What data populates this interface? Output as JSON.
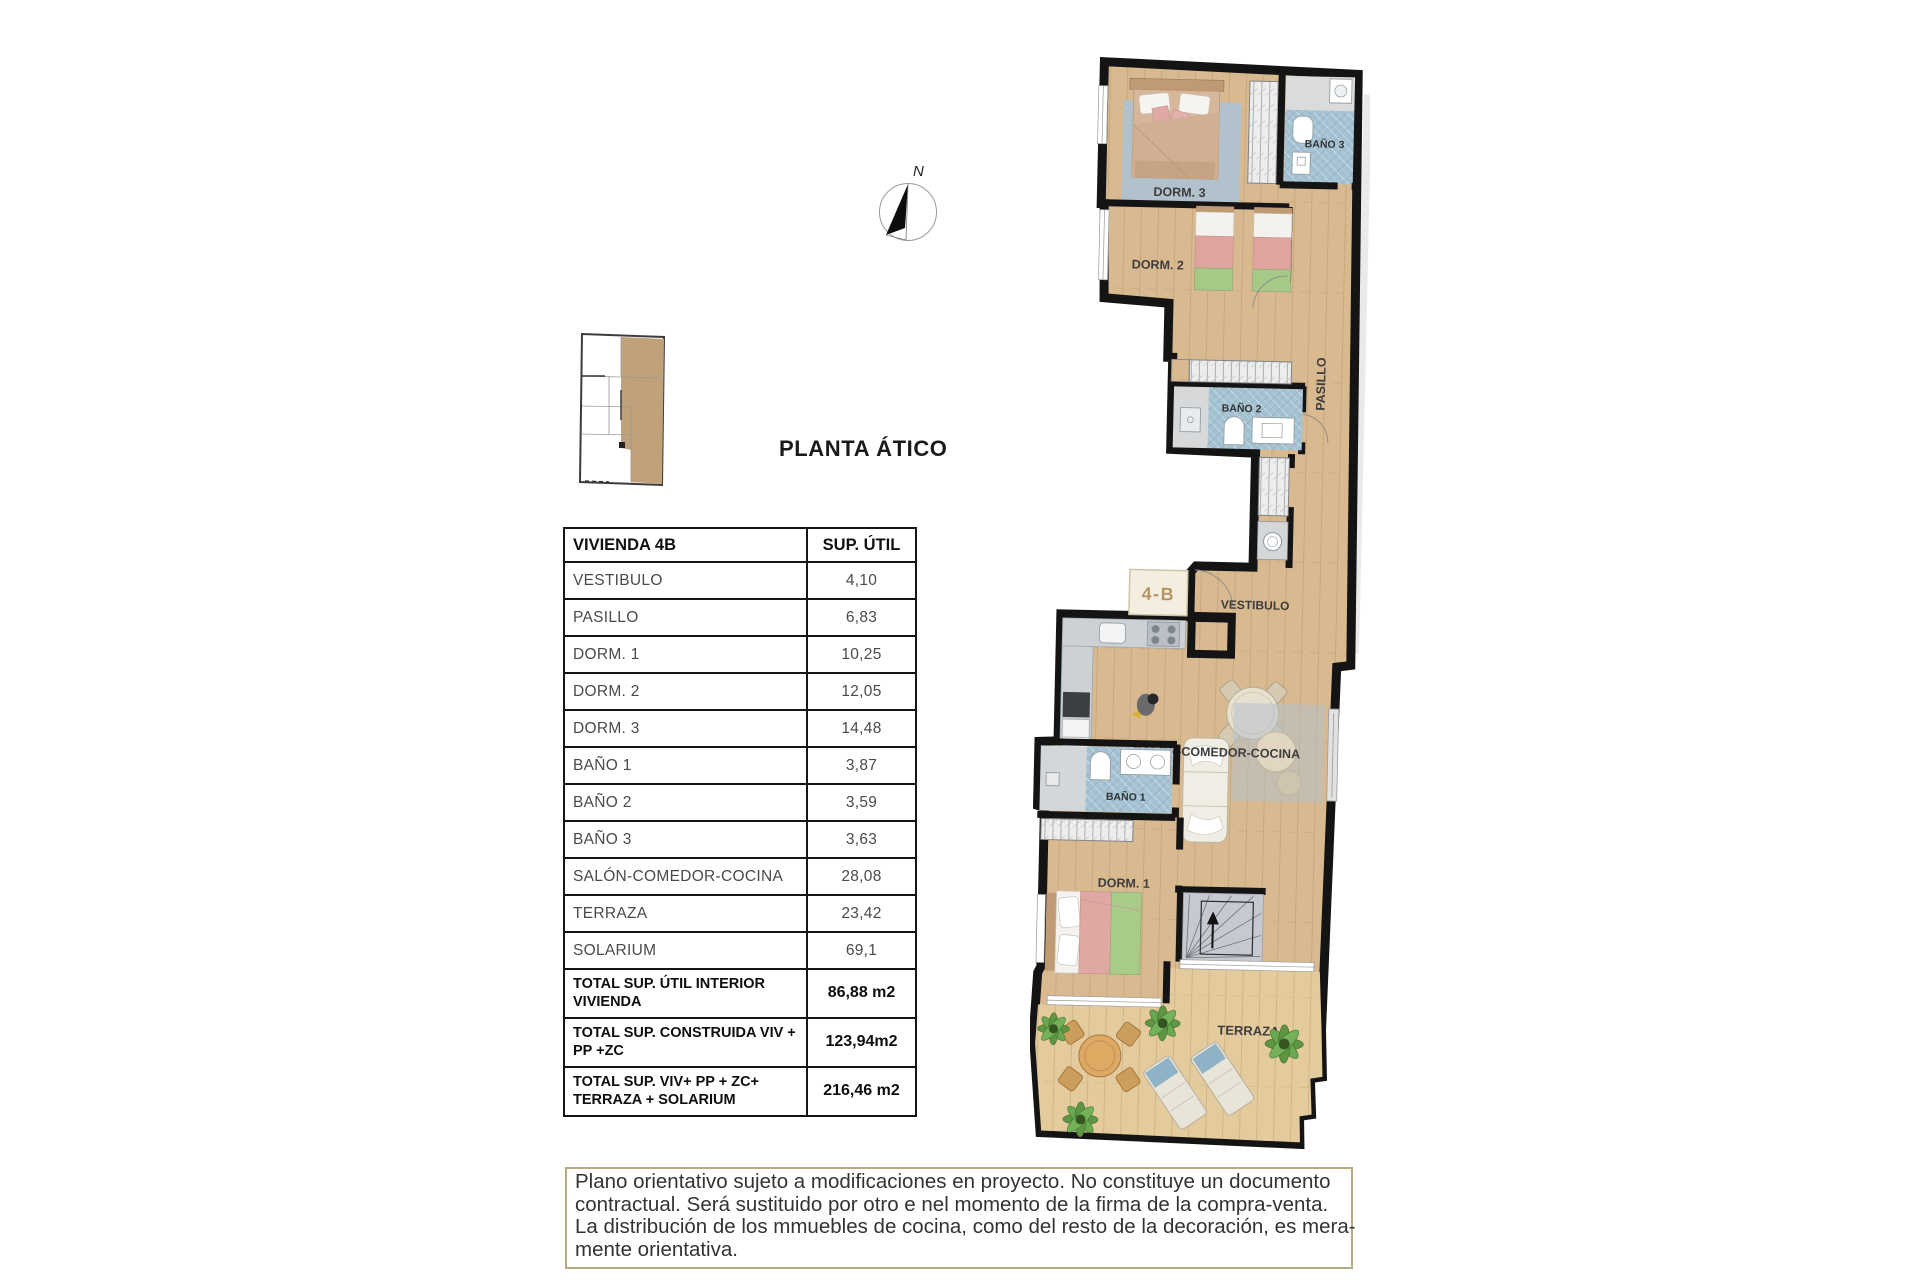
{
  "title": "PLANTA ÁTICO",
  "compass": {
    "north_label": "N"
  },
  "unit_badge": "4-B",
  "table": {
    "header": {
      "name": "VIVIENDA 4B",
      "unit": "SUP. ÚTIL"
    },
    "rows": [
      {
        "label": "VESTIBULO",
        "value": "4,10"
      },
      {
        "label": "PASILLO",
        "value": "6,83"
      },
      {
        "label": "DORM. 1",
        "value": "10,25"
      },
      {
        "label": "DORM. 2",
        "value": "12,05"
      },
      {
        "label": "DORM. 3",
        "value": "14,48"
      },
      {
        "label": "BAÑO 1",
        "value": "3,87"
      },
      {
        "label": "BAÑO 2",
        "value": "3,59"
      },
      {
        "label": "BAÑO 3",
        "value": "3,63"
      },
      {
        "label": "SALÓN-COMEDOR-COCINA",
        "value": "28,08"
      },
      {
        "label": "TERRAZA",
        "value": "23,42"
      },
      {
        "label": "SOLARIUM",
        "value": "69,1"
      }
    ],
    "totals": [
      {
        "label": "TOTAL SUP. ÚTIL INTERIOR VIVIENDA",
        "value": "86,88 m2"
      },
      {
        "label": "TOTAL SUP. CONSTRUIDA VIV + PP +ZC",
        "value": "123,94m2"
      },
      {
        "label": "TOTAL SUP. VIV+ PP + ZC+ TERRAZA + SOLARIUM",
        "value": "216,46 m2"
      }
    ]
  },
  "plan": {
    "rooms": {
      "dorm3": "DORM. 3",
      "bano3": "BAÑO 3",
      "dorm2": "DORM. 2",
      "bano2": "BAÑO 2",
      "pasillo": "PASILLO",
      "vestibulo": "VESTIBULO",
      "salon": "SALÓN-COMEDOR-COCINA",
      "bano1": "BAÑO 1",
      "dorm1": "DORM. 1",
      "terraza": "TERRAZA"
    }
  },
  "disclaimer": {
    "lines": [
      "Plano orientativo sujeto a modificaciones en proyecto. No constituye un documento",
      "contractual. Será sustituido por otro e nel momento de la firma de la compra-venta.",
      "La distribución de los mmuebles de cocina, como del resto de la decoración, es mera-",
      "mente orientativa."
    ]
  },
  "colors": {
    "wood": "#d9ba90",
    "terrace_wood": "#e4cb9e",
    "tile": "#a4c2d1",
    "wall": "#141414",
    "badge_text": "#b49563",
    "box_border": "#b6ab80",
    "highlight_tan": "#c1a179"
  }
}
